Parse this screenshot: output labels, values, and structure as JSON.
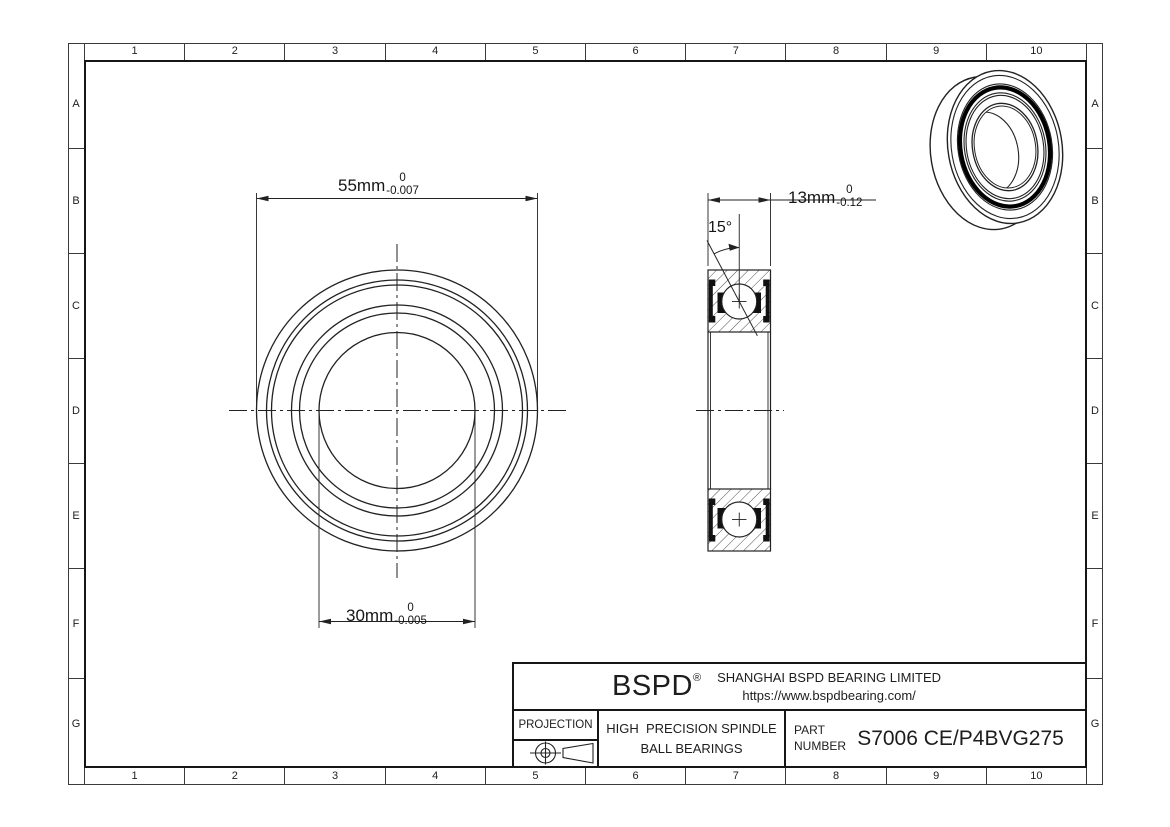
{
  "grid": {
    "cols": [
      "1",
      "2",
      "3",
      "4",
      "5",
      "6",
      "7",
      "8",
      "9",
      "10"
    ],
    "rows": [
      "A",
      "B",
      "C",
      "D",
      "E",
      "F",
      "G"
    ]
  },
  "dims": {
    "od": {
      "label": "55mm",
      "upper": "0",
      "lower": "-0.007"
    },
    "bore": {
      "label": "30mm",
      "upper": "0",
      "lower": "-0.005"
    },
    "width": {
      "label": "13mm",
      "upper": "0",
      "lower": "-0.12"
    },
    "contact_angle": "15°"
  },
  "title_block": {
    "logo": "BSPD",
    "logo_reg": "®",
    "company": "SHANGHAI BSPD BEARING LIMITED",
    "website": "https://www.bspdbearing.com/",
    "projection_label": "PROJECTION",
    "product_line1": "HIGH  PRECISION SPINDLE",
    "product_line2": "BALL BEARINGS",
    "part_label_line1": "PART",
    "part_label_line2": "NUMBER",
    "part_number": "S7006 CE/P4BVG275"
  },
  "colors": {
    "line": "#222222",
    "fill_dark": "#111111",
    "background": "#ffffff"
  }
}
